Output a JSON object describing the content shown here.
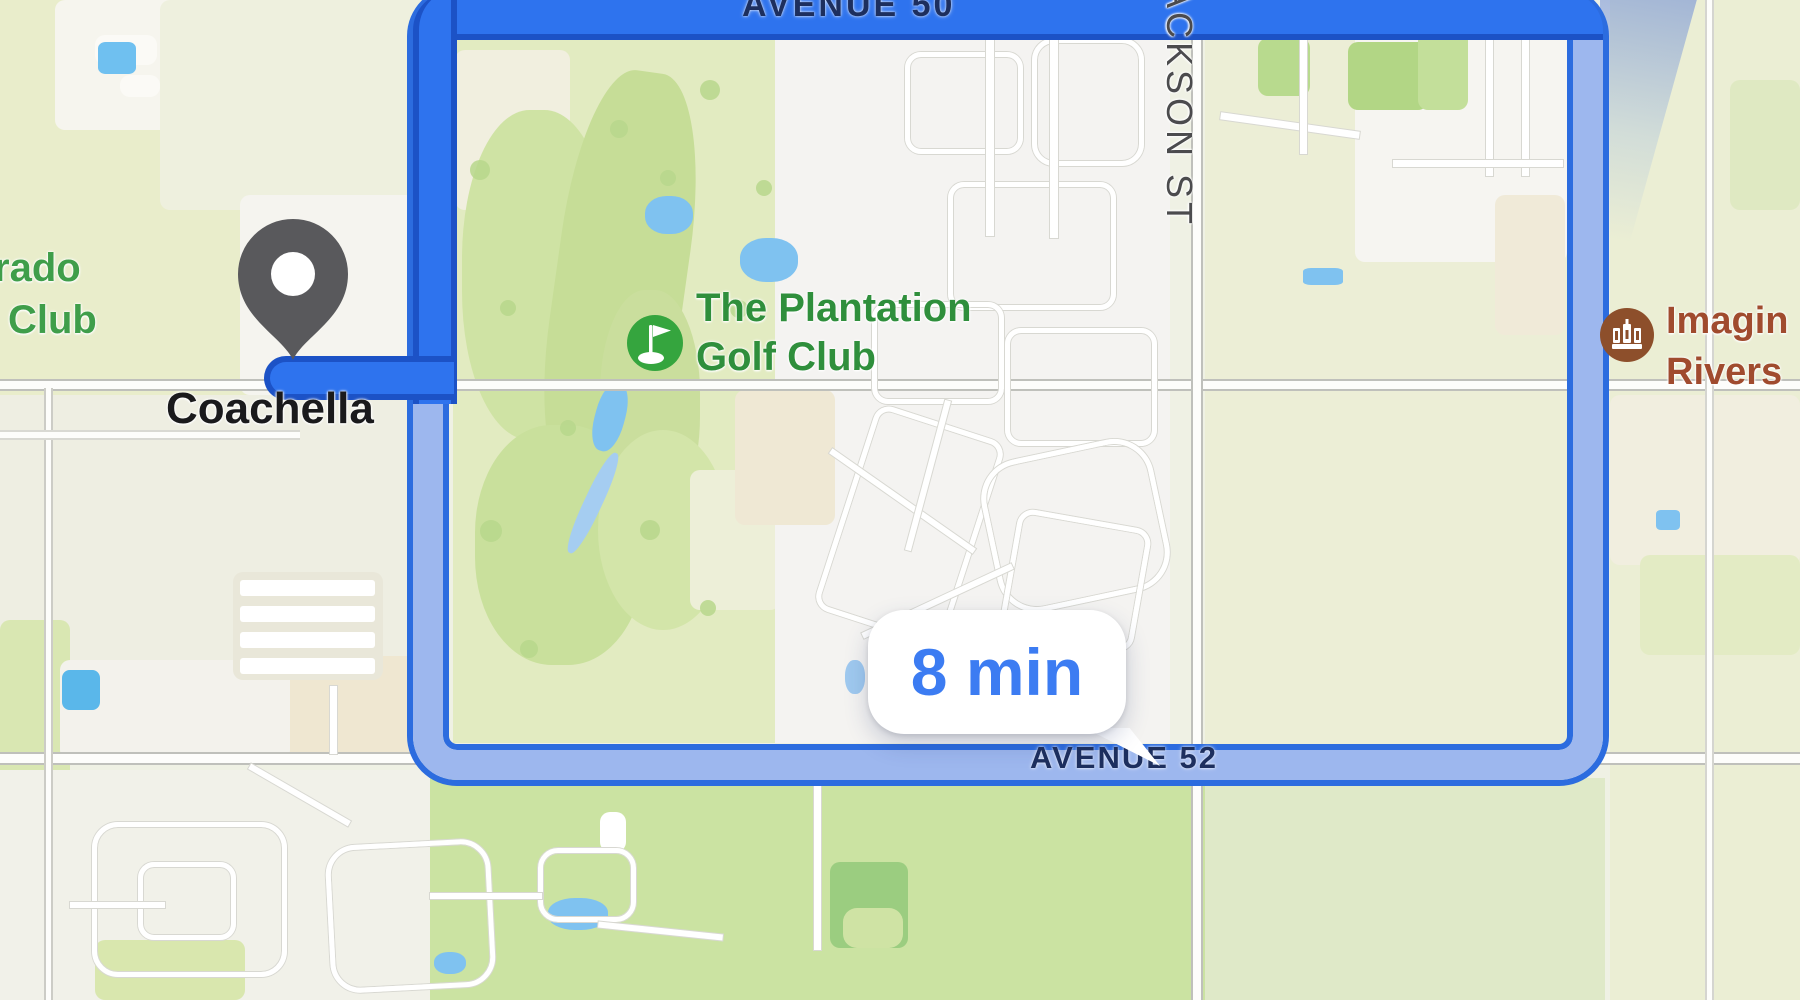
{
  "streets": {
    "avenue50": "AVENUE 50",
    "jackson": "JACKSON ST",
    "avenue52": "AVENUE 52"
  },
  "places": {
    "city": "Coachella",
    "golf_club": {
      "line1": "The Plantation",
      "line2": "Golf Club",
      "color": "#2f8f3c",
      "icon": "golf-flag",
      "icon_color": "#35a53e"
    },
    "left_partial": {
      "line1": "rado",
      "line2": "Club",
      "color": "#3f9e4a"
    },
    "right_partial": {
      "line1": "Imagin",
      "line2": "Rivers",
      "color": "#a04b2e",
      "icon": "museum-building",
      "icon_color": "#8d4f2b"
    }
  },
  "route": {
    "callout": "8 min",
    "callout_text_color": "#3c7cf2",
    "selected_color": "#2e73ee",
    "selected_border_color": "#1c52c6",
    "alternate_fill_color": "#9db7ee",
    "alternate_border_color": "#2c6cdf",
    "street_label_color": "#1d2f5e"
  },
  "marker": {
    "kind": "dropped-pin",
    "color": "#59595c"
  }
}
